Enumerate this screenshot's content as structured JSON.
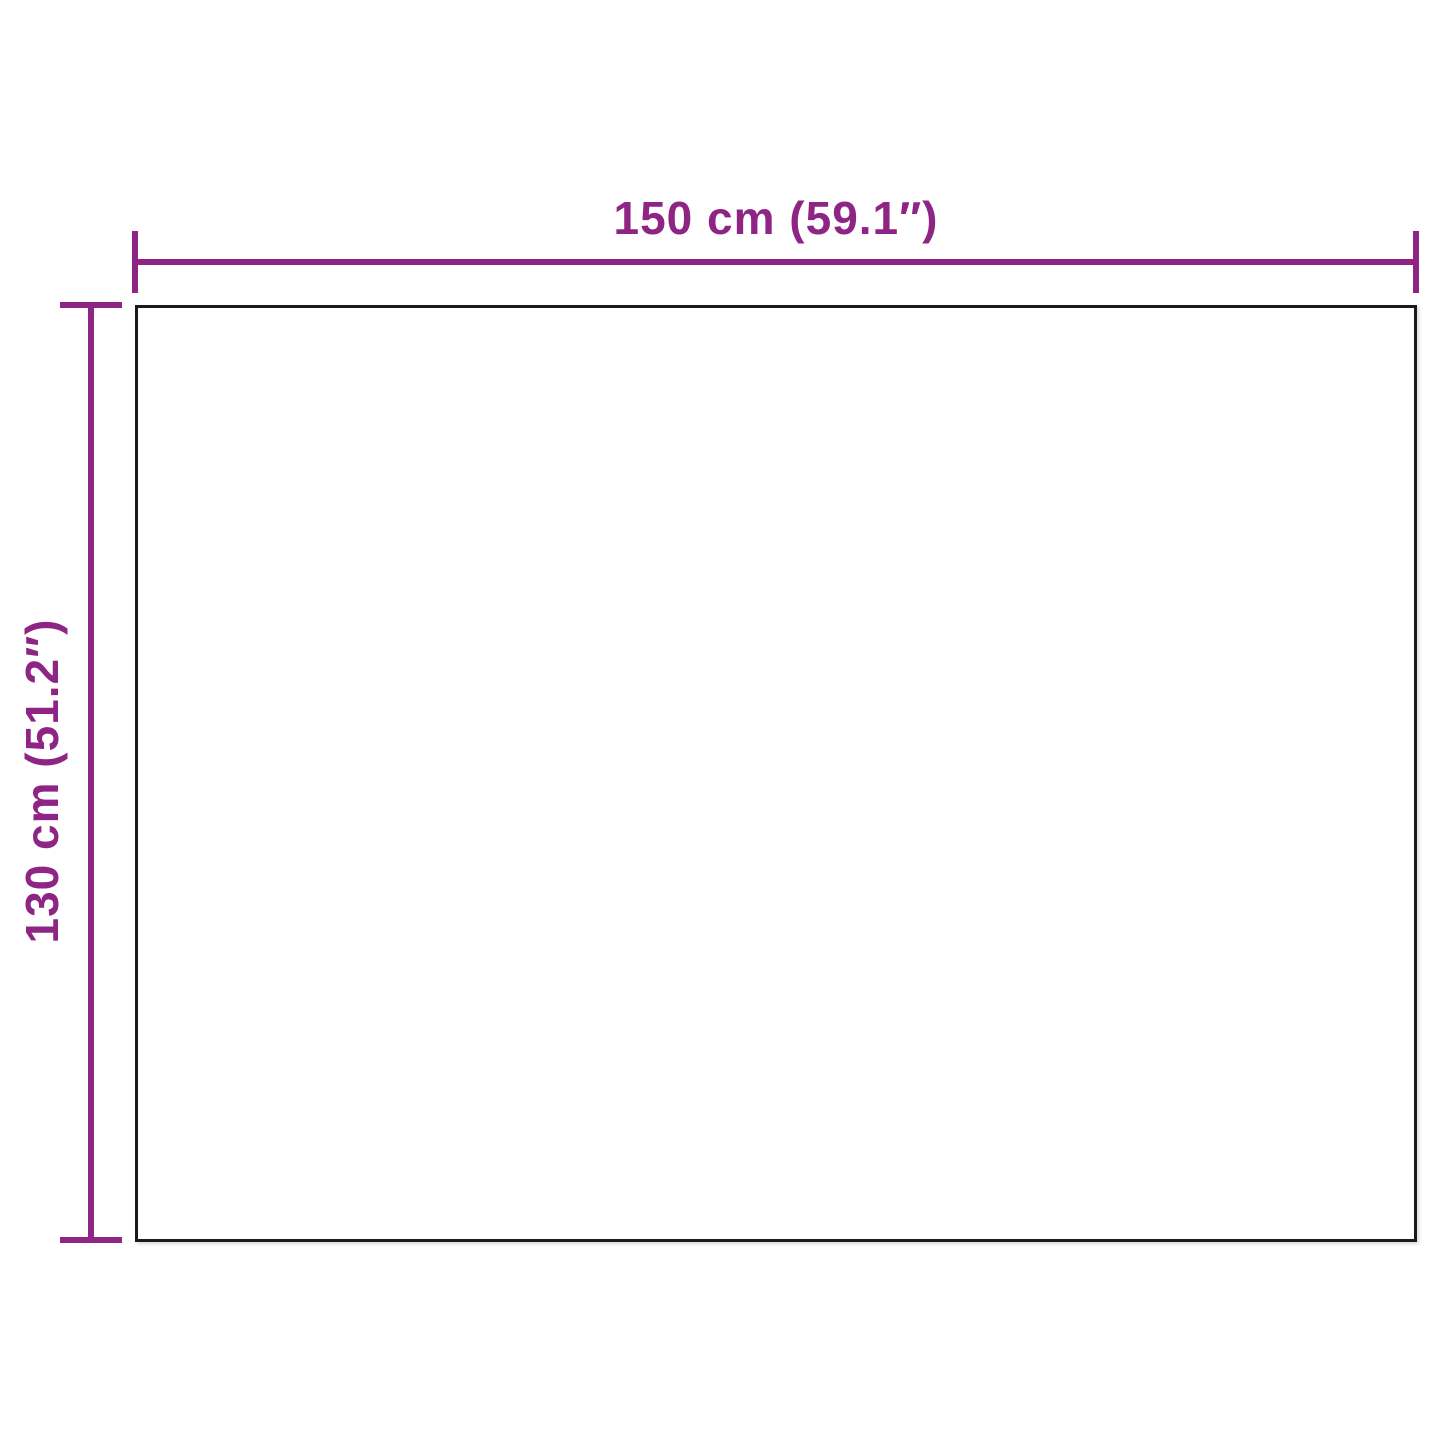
{
  "diagram": {
    "type": "product-dimension-diagram",
    "width_label": "150 cm (59.1″)",
    "height_label": "130 cm (51.2″)",
    "colors": {
      "dimension_accent": "#8E2483",
      "outline": "#1A1A1A",
      "background": "#FFFFFF"
    }
  }
}
